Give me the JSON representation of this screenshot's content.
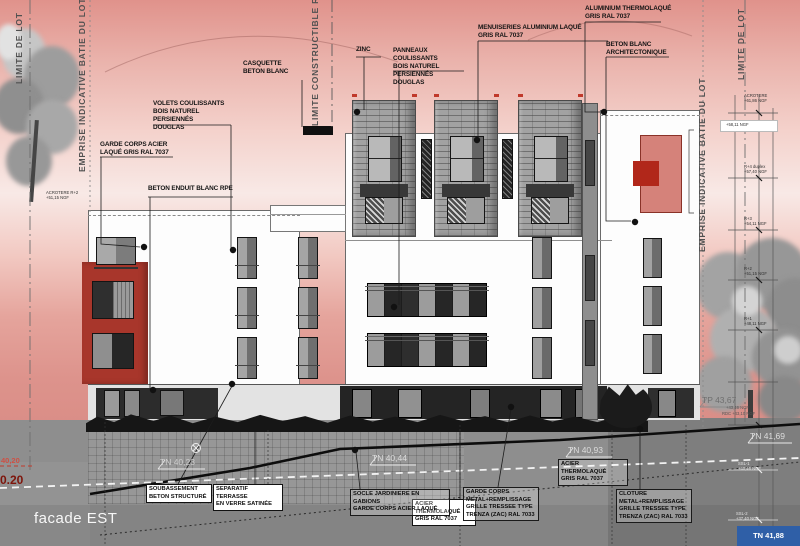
{
  "drawing": {
    "title": "facade EST"
  },
  "boundaries": {
    "limite_lot_left": "LIMITE DE LOT",
    "emprise_left": "EMPRISE INDICATIVE BATIE DU LOT",
    "limite_constructible": "LIMITE CONSTRUCTIBLE R+4",
    "emprise_right": "EMPRISE INDICATIVE BATIE DU LOT",
    "limite_lot_right": "LIMITE DE LOT"
  },
  "callouts": {
    "casquette": "CASQUETTE\nBETON BLANC",
    "zinc": "ZINC",
    "panneaux": "PANNEAUX COULISSANTS\nBOIS NATUREL PERSIENNÉS\nDOUGLAS",
    "menuiseries": "MENUISERIES ALUMINIUM LAQUÉ\nGRIS RAL 7037",
    "aluminium": "ALUMINIUM THERMOLAQUÉ\nGRIS RAL 7037",
    "beton_blanc": "BETON BLANC\nARCHITECTONIQUE",
    "volets": "VOLETS COULISSANTS\nBOIS NATUREL PERSIENNÉS\nDOUGLAS",
    "garde_corps_acier": "GARDE CORPS ACIER\nLAQUÉ GRIS RAL 7037",
    "beton_enduit": "BETON ENDUIT BLANC RPE",
    "soubassement": "SOUBASSEMENT\nBETON STRUCTURÉ",
    "separatif": "SEPARATIF TERRASSE\nEN VERRE SATINÉE",
    "acier_thermo_center": "ACIER THERMOLAQUÉ\nGRIS RAL 7037",
    "socle": "SOCLE JARDINIERE EN GABIONS\nGARDE CORPS ACIER LAQUÉ",
    "garde_corps_metal": "GARDE CORPS\nMETAL+REMPLISSAGE\nGRILLE TRESSEE TYPE\nTRENZA (ZAC) RAL 7033",
    "acier_thermo_right": "ACIER THERMOLAQUÉ\nGRIS RAL 7037",
    "cloture": "CLOTURE\nMETAL+REMPLISSAGE\nGRILLE TRESSEE TYPE\nTRENZA (ZAC) RAL 7033"
  },
  "levels": {
    "left_edge_top": "40,20",
    "left_edge_bottom": "0.20",
    "tn_40_23": "TN 40,23",
    "tn_40_44": "TN 40,44",
    "tn_40_93": "TN 40,93",
    "tn_41_69": "TN 41,69",
    "tp_43_67": "TP 43,67",
    "corner_badge": "TN 41,88"
  },
  "ladder": {
    "acrotere": "ACROTERE\n+61,86 NGF",
    "band": "+58,11 NGF",
    "r4": "R+4 duplex\n+57,40 NGF",
    "r3": "R+3\n+54,11 NGF",
    "r2": "R+2\n+51,15 NGF",
    "r1": "R+1\n+48,11 NGF",
    "ssl1": "SSL-1\n+40,46 NGF",
    "ssl2": "SSL-2\n+37,40 NGF",
    "acrotere_r2_left": "ACROTERE R+2\n+51,15 NGF",
    "tp_sub": "+43,46 NGF",
    "rdc_tp": "RDC +43,10 NGF"
  },
  "colors": {
    "sky_top": "#e0928b",
    "red_block": "#a8362b",
    "red_square": "#b1271a",
    "pink_panel": "#d5827a",
    "badge_blue": "#2f5fa7",
    "ground_gray": "#8e8e8e"
  }
}
